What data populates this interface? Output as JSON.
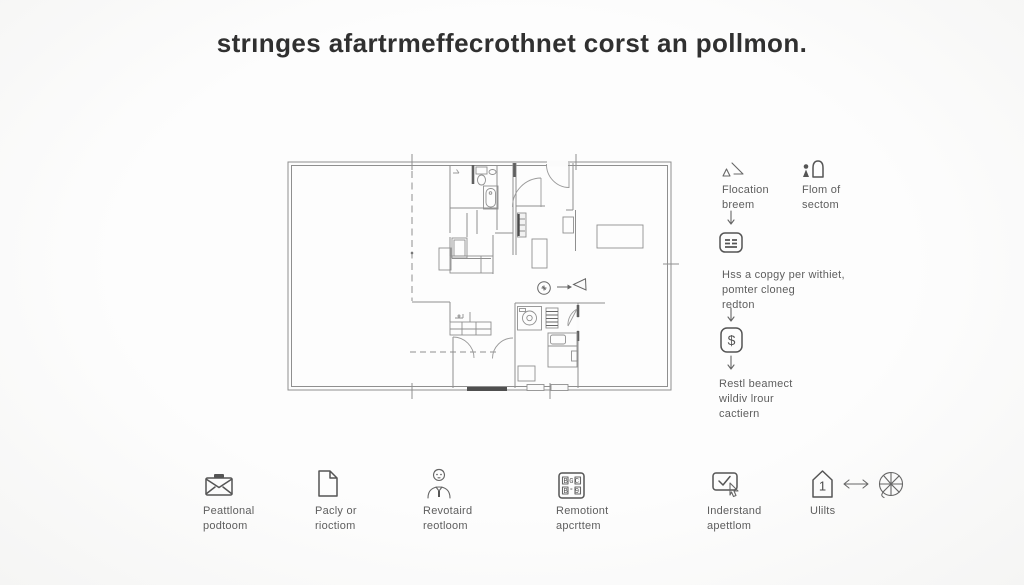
{
  "title": "strınges afartrmeffecrothnet corst an pollmon.",
  "colors": {
    "background": "#fbfbfb",
    "title_text": "#303030",
    "label_text": "#5e5e5e",
    "line_art": "#8f8f8f",
    "icon_stroke": "#555555"
  },
  "flow": {
    "branch": [
      {
        "icon": "drafting-slope-icon",
        "label": "Flocation\nbreem"
      },
      {
        "icon": "person-door-icon",
        "label": "Flom of\nsectom"
      }
    ],
    "steps": [
      {
        "icon": "form-card-icon",
        "text": "Hss a copgy per withiet,\npomter cloneg\nredton"
      },
      {
        "icon": "dollar-icon",
        "glyph": "$",
        "text": "Restl beamect\nwildiv lrour\ncactiern"
      }
    ]
  },
  "legend": {
    "items": [
      {
        "icon": "envelope-icon",
        "label": "Peattlonal\npodtoom"
      },
      {
        "icon": "document-icon",
        "label": "Pacly or\nrioctiom"
      },
      {
        "icon": "person-icon",
        "label": "Revotaird\nreotloom"
      },
      {
        "icon": "keypad-icon",
        "label": "Remotiont\napcrttem",
        "keypad_rows": [
          "BGC",
          "B°9"
        ]
      },
      {
        "icon": "checkbox-cursor-icon",
        "label": "Inderstand\napettlom"
      },
      {
        "icon": "house-number-icon",
        "label": "Ulilts",
        "house_number": "1"
      },
      {
        "icon": "arrows-left-right-icon",
        "label": ""
      },
      {
        "icon": "wheel-icon",
        "label": ""
      }
    ]
  }
}
